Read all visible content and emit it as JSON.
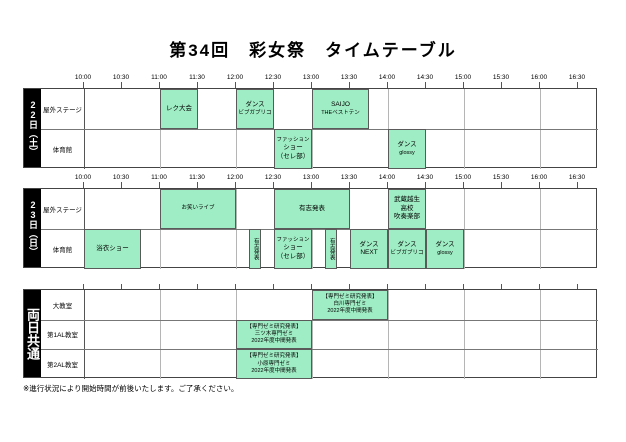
{
  "title": "第34回　彩女祭　タイムテーブル",
  "footer_note": "※進行状況により開始時間が前後いたします。ご了承ください。",
  "colors": {
    "event_fill": "#9FEDC4",
    "event_border": "#5a5a5a",
    "day_bar_bg": "#000000",
    "day_bar_text": "#ffffff"
  },
  "time_axis": {
    "start": "10:00",
    "end": "16:30",
    "labels": [
      "10:00",
      "10:30",
      "11:00",
      "11:30",
      "12:00",
      "12:30",
      "13:00",
      "13:30",
      "14:00",
      "14:30",
      "15:00",
      "15:30",
      "16:00",
      "16:30"
    ]
  },
  "sections": [
    {
      "day_label": "22日（土）",
      "rows": [
        {
          "name": "屋外ステージ",
          "events": [
            {
              "lines": [
                "レク大会"
              ],
              "start": "11:00",
              "end": "11:30"
            },
            {
              "lines": [
                "ダンス",
                "ビブガブリコ"
              ],
              "start": "12:00",
              "end": "12:30"
            },
            {
              "lines": [
                "SAIJO",
                "THEベストテン"
              ],
              "start": "13:00",
              "end": "13:45"
            }
          ]
        },
        {
          "name": "体育館",
          "events": [
            {
              "lines": [
                "ファッション",
                "ショー",
                "（セレ部）"
              ],
              "start": "12:30",
              "end": "13:00"
            },
            {
              "lines": [
                "ダンス",
                "glossy"
              ],
              "start": "14:00",
              "end": "14:30"
            }
          ]
        }
      ]
    },
    {
      "day_label": "23日（日）",
      "rows": [
        {
          "name": "屋外ステージ",
          "events": [
            {
              "lines": [
                "お笑いライブ"
              ],
              "start": "11:00",
              "end": "12:00"
            },
            {
              "lines": [
                "有志発表"
              ],
              "start": "12:30",
              "end": "13:30"
            },
            {
              "lines": [
                "武蔵越生",
                "高校",
                "吹奏楽部"
              ],
              "start": "14:00",
              "end": "14:30"
            }
          ]
        },
        {
          "name": "体育館",
          "events": [
            {
              "lines": [
                "浴衣ショー"
              ],
              "start": "10:00",
              "end": "10:45"
            },
            {
              "lines": [
                "有志発表"
              ],
              "start": "12:10",
              "end": "12:20",
              "vertical": true
            },
            {
              "lines": [
                "ファッション",
                "ショー",
                "（セレ部）"
              ],
              "start": "12:30",
              "end": "13:00"
            },
            {
              "lines": [
                "有志発表"
              ],
              "start": "13:10",
              "end": "13:20",
              "vertical": true
            },
            {
              "lines": [
                "ダンス",
                "NEXT"
              ],
              "start": "13:30",
              "end": "14:00"
            },
            {
              "lines": [
                "ダンス",
                "ビブガブリコ"
              ],
              "start": "14:00",
              "end": "14:30"
            },
            {
              "lines": [
                "ダンス",
                "glossy"
              ],
              "start": "14:30",
              "end": "15:00"
            }
          ]
        }
      ]
    },
    {
      "day_label": "両日共通",
      "rows": [
        {
          "name": "大教室",
          "events": [
            {
              "lines": [
                "【専門ゼミ研究発表】",
                "白川専門ゼミ",
                "2022年度中間発表"
              ],
              "start": "13:00",
              "end": "14:00"
            }
          ]
        },
        {
          "name": "第1AL教室",
          "events": [
            {
              "lines": [
                "【専門ゼミ研究発表】",
                "三ツ木専門ゼミ",
                "2022年度中間発表"
              ],
              "start": "12:00",
              "end": "13:00"
            }
          ]
        },
        {
          "name": "第2AL教室",
          "events": [
            {
              "lines": [
                "【専門ゼミ研究発表】",
                "小原専門ゼミ",
                "2022年度中間発表"
              ],
              "start": "12:00",
              "end": "13:00"
            }
          ]
        }
      ]
    }
  ]
}
